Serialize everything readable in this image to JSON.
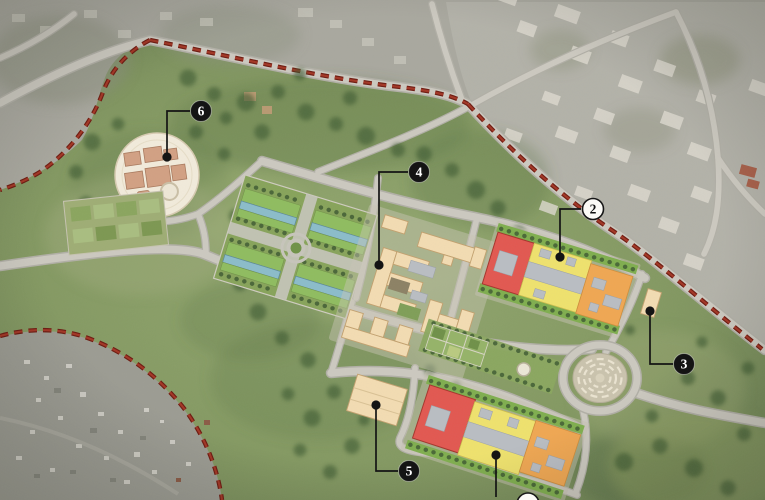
{
  "markers": [
    {
      "label": "2",
      "variant": "light"
    },
    {
      "label": "3",
      "variant": "dark"
    },
    {
      "label": "4",
      "variant": "dark"
    },
    {
      "label": "5",
      "variant": "dark"
    },
    {
      "label": "6",
      "variant": "dark"
    },
    {
      "label": "",
      "variant": "light"
    }
  ],
  "palette": {
    "boundary-red": "#8f2317",
    "road-fill": "#ccc9c0",
    "road-casing": "#b1afa6",
    "site-green": "#849962",
    "city-gray": "#a9a89f",
    "building-red": "#e25750",
    "building-red-line": "#a5352c",
    "building-yellow": "#efe26d",
    "building-orange": "#f0a752",
    "building-cream": "#f3dcb2",
    "building-clay": "#d2a083",
    "roof-gray": "#b9bdc3",
    "lawn-green": "#8fbc5f",
    "water-blue": "#8bbcca",
    "hedge-green": "#7fae4e",
    "tree-green": "#3f5c33",
    "platform-cream": "#f2ebdb",
    "marker-dark": "#141414",
    "marker-light": "#fbfaf6"
  }
}
